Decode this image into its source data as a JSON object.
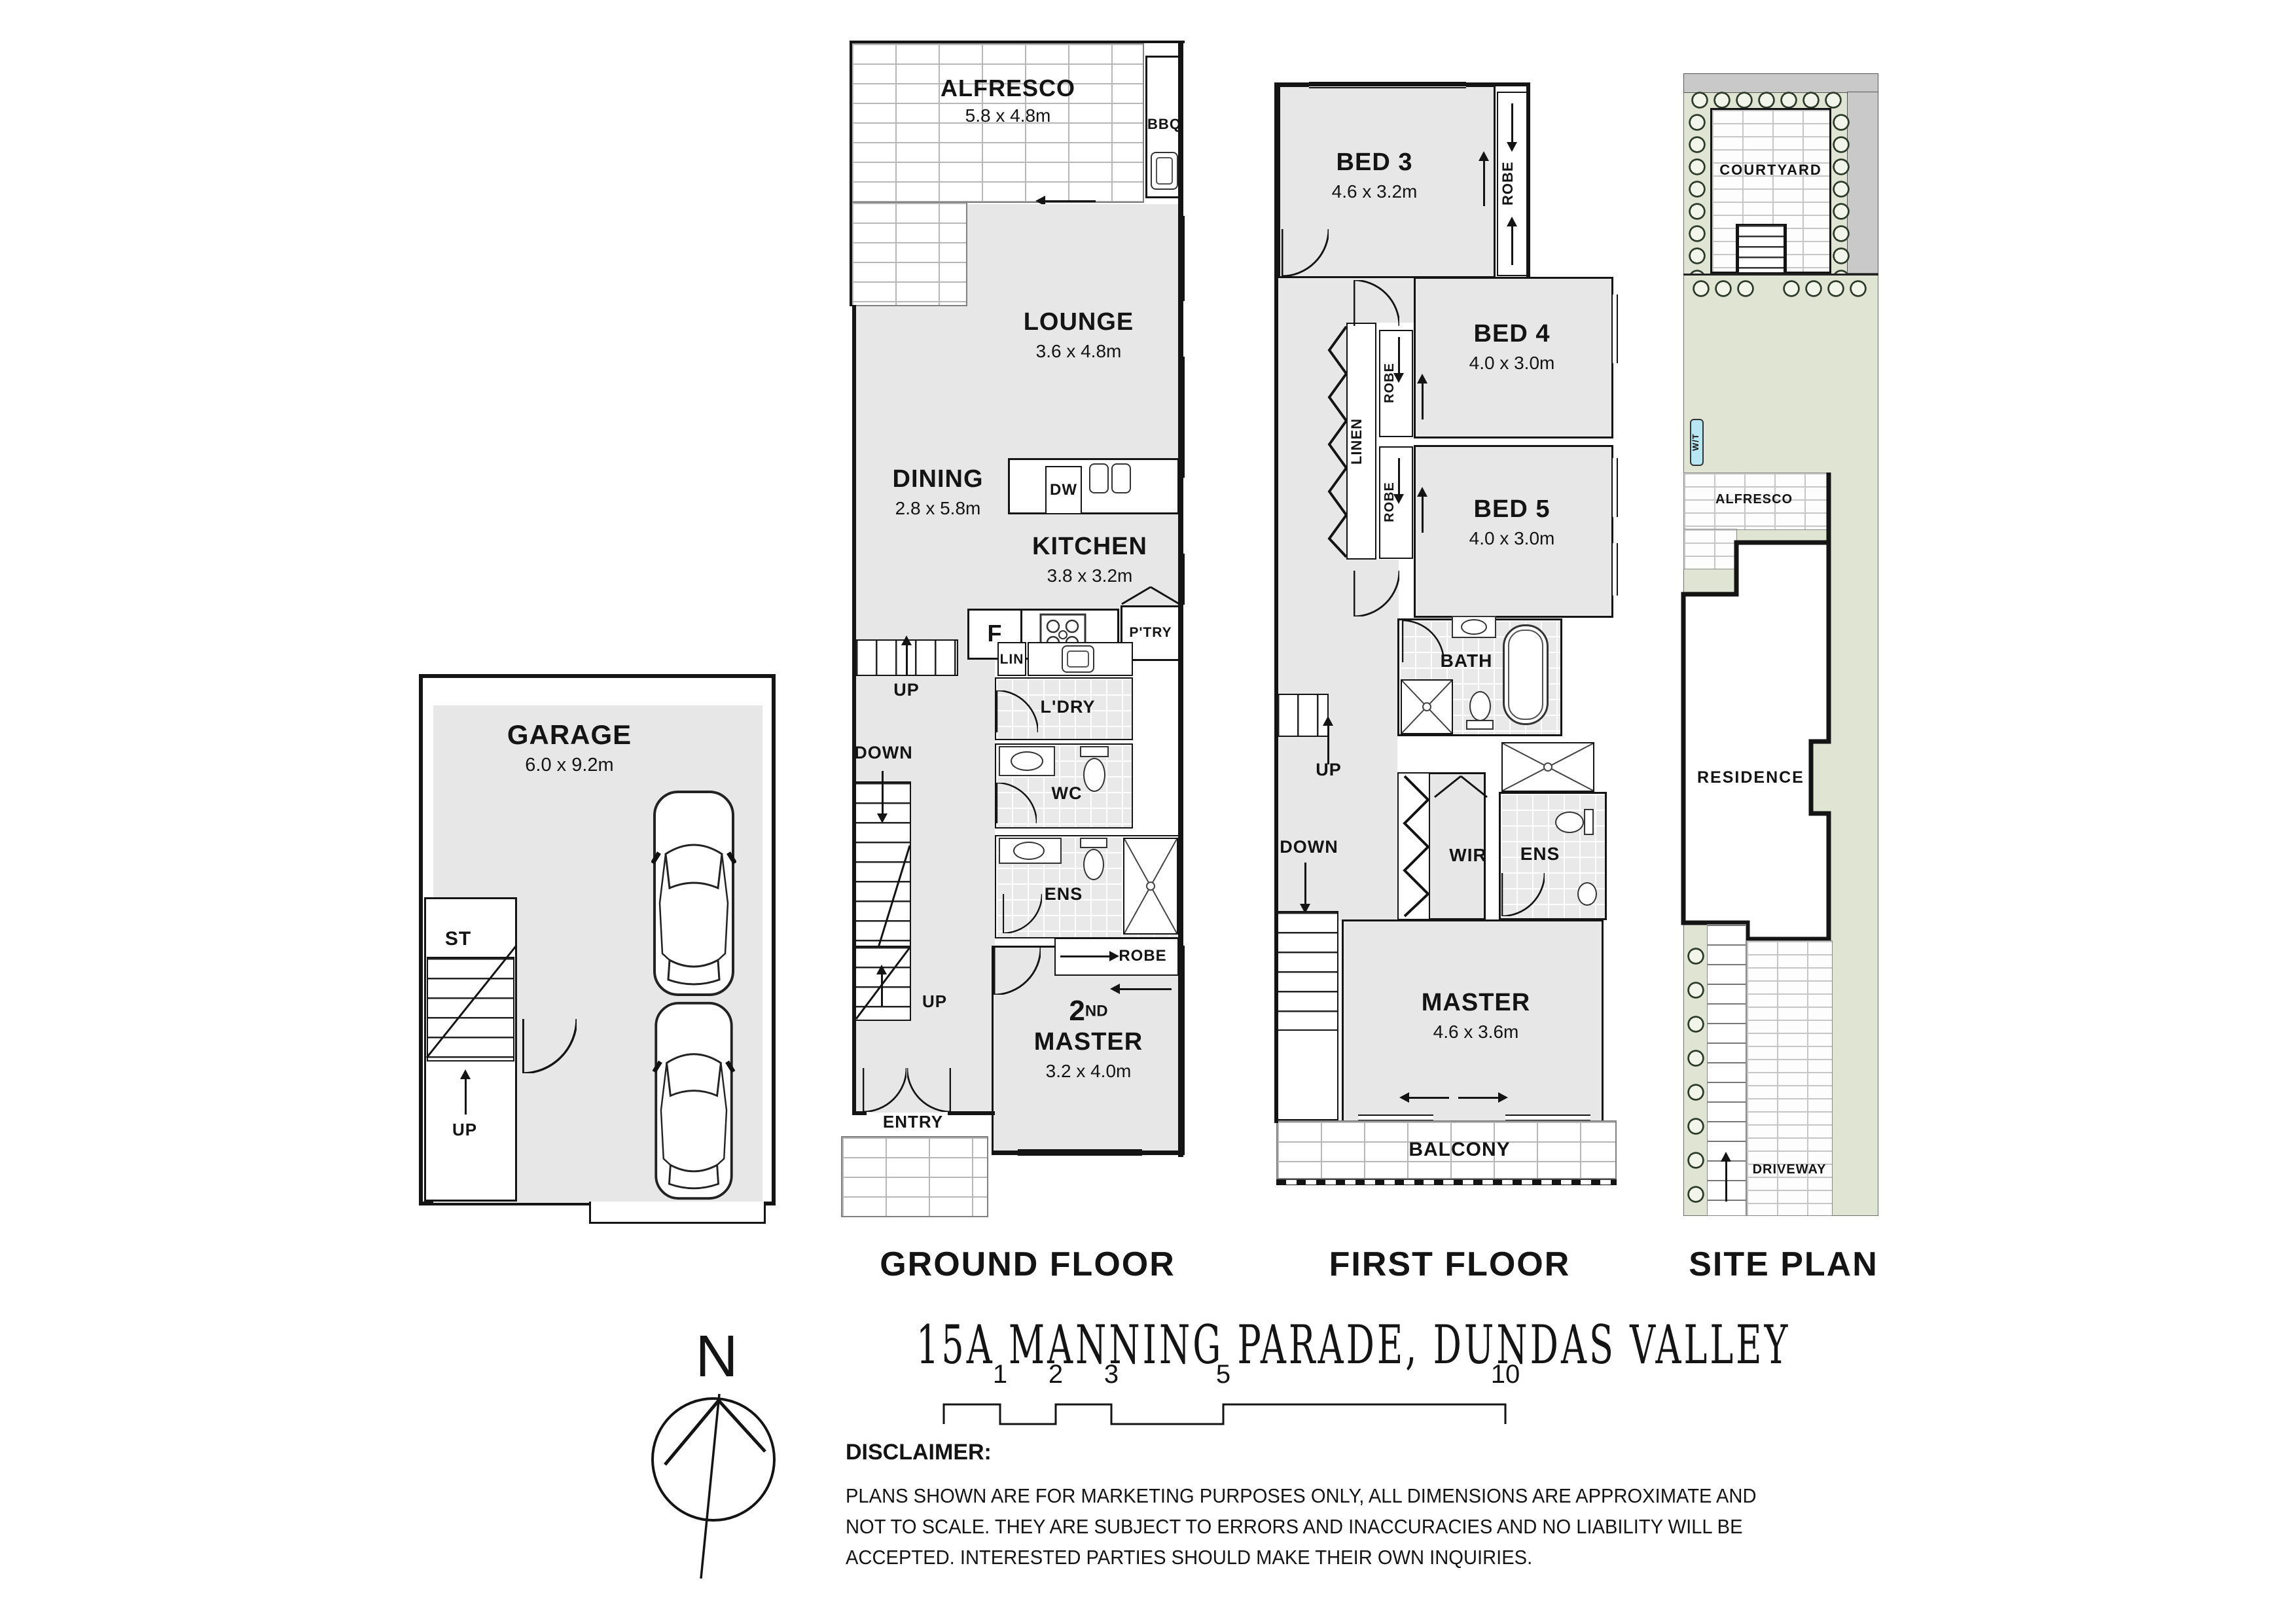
{
  "title": "15A MANNING PARADE, DUNDAS VALLEY",
  "floor_labels": {
    "ground": "GROUND FLOOR",
    "first": "FIRST FLOOR",
    "site": "SITE PLAN"
  },
  "garage": {
    "name": "GARAGE",
    "dim": "6.0 x 9.2m",
    "st": "ST",
    "up": "UP"
  },
  "ground": {
    "alfresco": "ALFRESCO",
    "alfresco_dim": "5.8 x 4.8m",
    "bbq": "BBQ",
    "lounge": "LOUNGE",
    "lounge_dim": "3.6 x 4.8m",
    "dining": "DINING",
    "dining_dim": "2.8 x 5.8m",
    "kitchen": "KITCHEN",
    "kitchen_dim": "3.8 x 3.2m",
    "dw": "DW",
    "fridge": "F",
    "pantry": "P'TRY",
    "linen": "LIN",
    "laundry": "L'DRY",
    "wc": "WC",
    "ens": "ENS",
    "robe": "ROBE",
    "up_top": "UP",
    "down": "DOWN",
    "up_entry": "UP",
    "entry": "ENTRY",
    "master_num": "2",
    "master_sup": "ND",
    "master_name": "MASTER",
    "master_dim": "3.2 x 4.0m"
  },
  "first": {
    "bed3": "BED 3",
    "bed3_dim": "4.6 x 3.2m",
    "robe_bed3": "ROBE",
    "bed4": "BED 4",
    "bed4_dim": "4.0 x 3.0m",
    "robe_bed4": "ROBE",
    "bed5": "BED 5",
    "bed5_dim": "4.0 x 3.0m",
    "robe_bed5": "ROBE",
    "linen": "LINEN",
    "bath": "BATH",
    "wir": "WIR",
    "ens": "ENS",
    "master": "MASTER",
    "master_dim": "4.6 x 3.6m",
    "balcony": "BALCONY",
    "up": "UP",
    "down": "DOWN"
  },
  "site": {
    "courtyard": "COURTYARD",
    "water_tank": "W/T",
    "alfresco": "ALFRESCO",
    "residence": "RESIDENCE",
    "driveway": "DRIVEWAY"
  },
  "compass": {
    "north": "N"
  },
  "scale_bar": {
    "ticks": [
      "1",
      "2",
      "3",
      "5",
      "10"
    ]
  },
  "disclaimer": {
    "heading": "DISCLAIMER:",
    "lines": [
      "PLANS SHOWN ARE FOR MARKETING PURPOSES ONLY, ALL DIMENSIONS ARE APPROXIMATE AND",
      "NOT TO SCALE. THEY ARE SUBJECT TO ERRORS AND INACCURACIES AND NO LIABILITY WILL BE",
      "ACCEPTED. INTERESTED PARTIES SHOULD MAKE THEIR OWN INQUIRIES."
    ]
  },
  "colors": {
    "wall": "#141414",
    "room_fill": "#e7e7e7",
    "tile_fill": "#e9e9e9",
    "site_green": "#dfe5d2",
    "site_grey": "#c9c9c9",
    "water_tank_blue": "#b8e7f3"
  }
}
